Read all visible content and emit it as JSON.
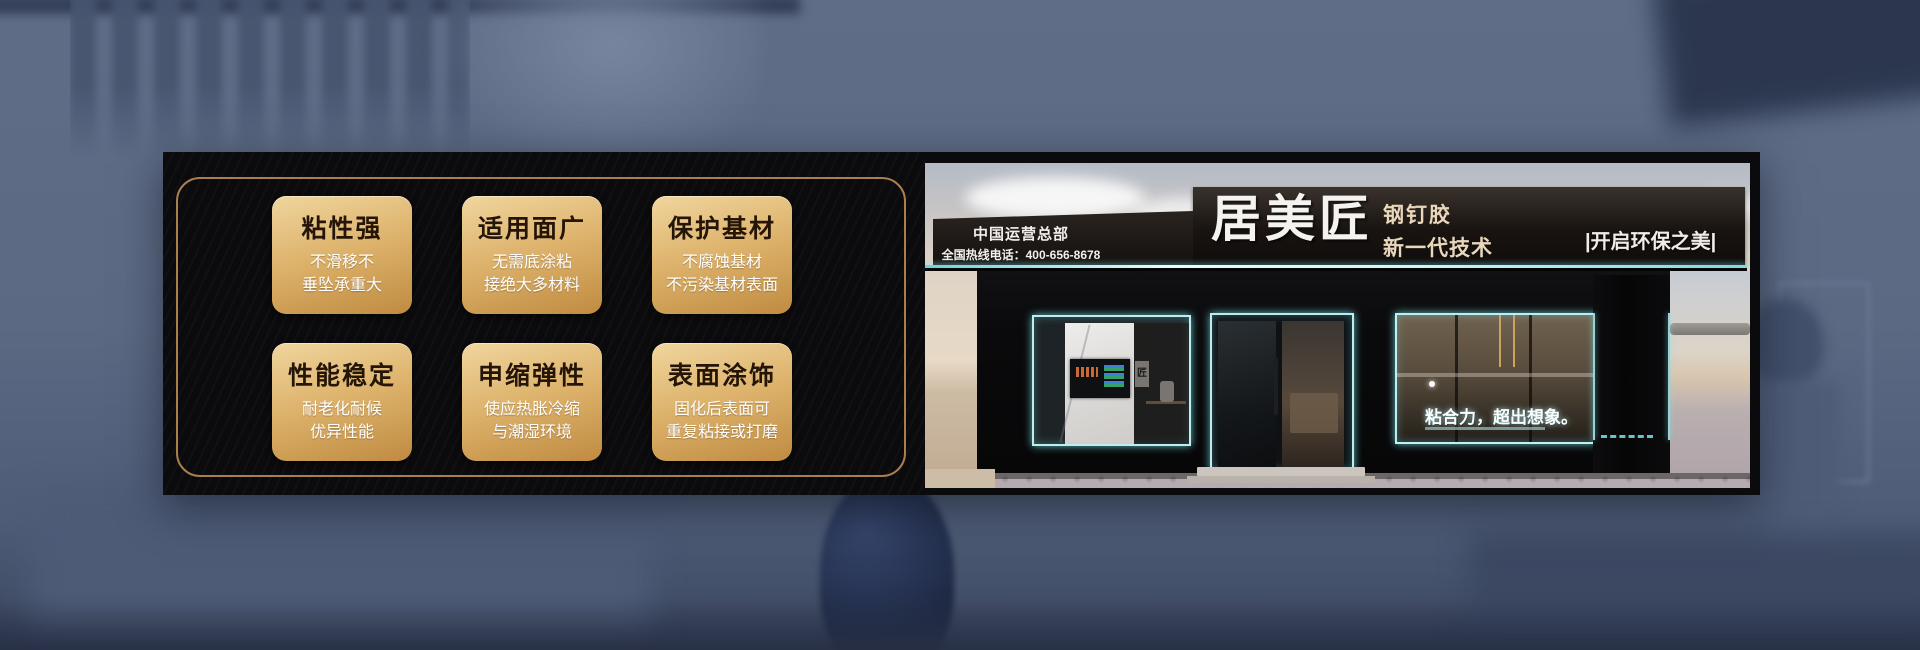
{
  "features": {
    "cards": [
      {
        "title": "粘性强",
        "lines": [
          "不滑移不",
          "垂坠承重大"
        ]
      },
      {
        "title": "适用面广",
        "lines": [
          "无需底涂粘",
          "接绝大多材料"
        ]
      },
      {
        "title": "保护基材",
        "lines": [
          "不腐蚀基材",
          "不污染基材表面"
        ]
      },
      {
        "title": "性能稳定",
        "lines": [
          "耐老化耐候",
          "优异性能"
        ]
      },
      {
        "title": "申缩弹性",
        "lines": [
          "使应热胀冷缩",
          "与潮湿环境"
        ]
      },
      {
        "title": "表面涂饰",
        "lines": [
          "固化后表面可",
          "重复粘接或打磨"
        ]
      }
    ]
  },
  "storefront": {
    "operations_hq": "中国运营总部",
    "hotline": "全国热线电话：400-656-8678",
    "brand_name": "居美匠",
    "product_name": "钢钉胶",
    "tagline": "新一代技术",
    "slogan": "|开启环保之美|",
    "window_slogan": "粘合力，超出想象。",
    "logo_mark": "匠"
  },
  "colors": {
    "card_gold_top": "#f0d69e",
    "card_gold_bottom": "#c08b41",
    "card_title_text": "#241507",
    "panel_black": "#0b0a0c",
    "gold_border": "#a97f4e",
    "neon_cyan": "#aef2f5",
    "sign_text_gold": "#e9d6bb",
    "background_blue": "#5b6983"
  }
}
